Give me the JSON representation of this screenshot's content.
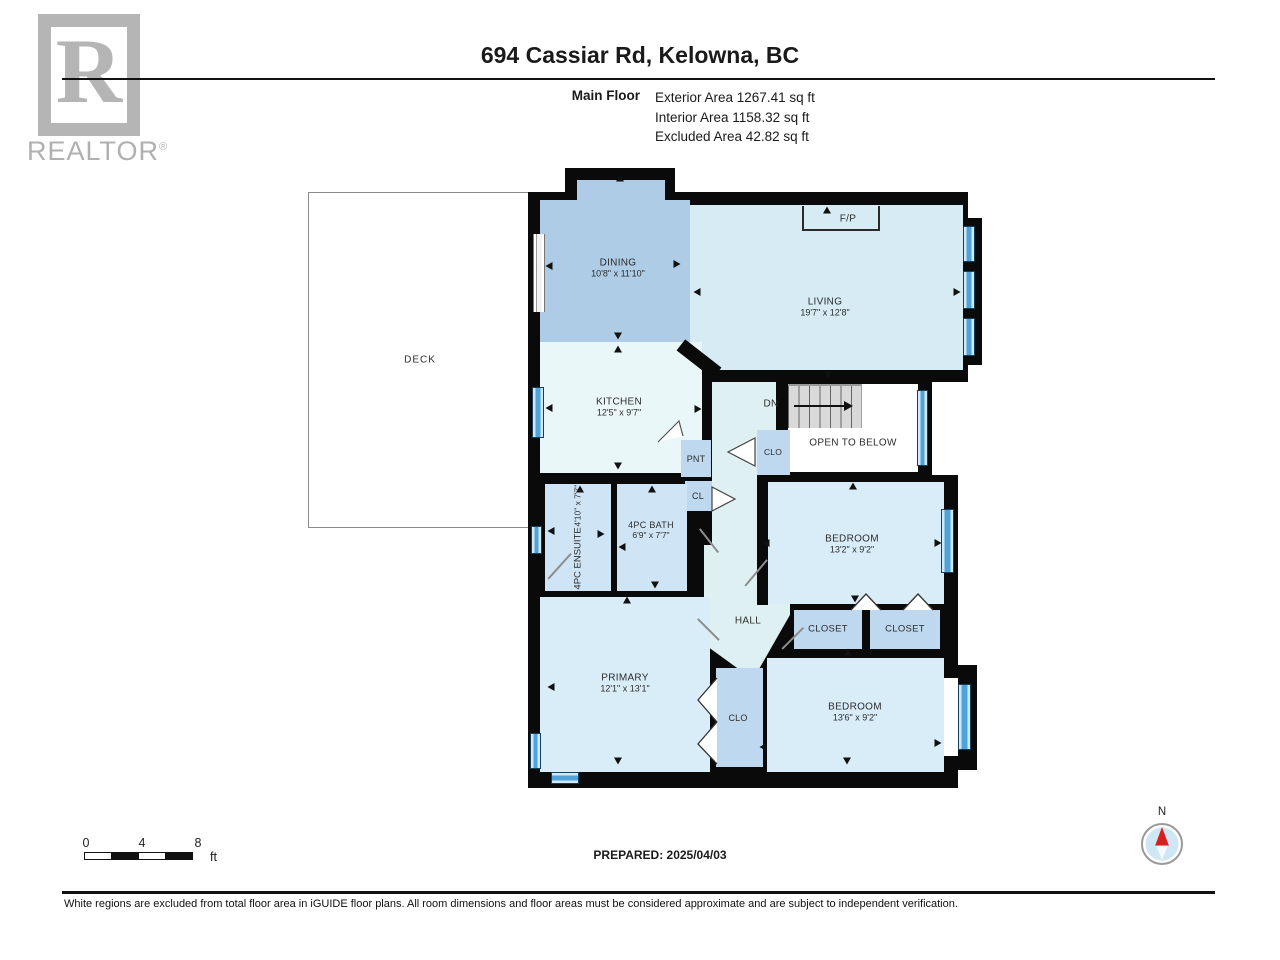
{
  "header": {
    "logo_word": "REALTOR",
    "logo_reg": "®",
    "logo_letter": "R",
    "title": "694 Cassiar Rd, Kelowna, BC",
    "floor_label": "Main Floor",
    "area_lines": {
      "exterior": "Exterior Area 1267.41 sq ft",
      "interior": "Interior Area 1158.32 sq ft",
      "excluded": "Excluded Area 42.82 sq ft"
    }
  },
  "rooms": {
    "deck": {
      "name": "DECK"
    },
    "dining": {
      "name": "DINING",
      "dims": "10'8\" x 11'10\""
    },
    "living": {
      "name": "LIVING",
      "dims": "19'7\" x 12'8\""
    },
    "kitchen": {
      "name": "KITCHEN",
      "dims": "12'5\" x 9'7\""
    },
    "fireplace": {
      "name": "F/P"
    },
    "stairs_down": {
      "name": "DN"
    },
    "open_below": {
      "name": "OPEN TO BELOW"
    },
    "clo_stairs": {
      "name": "CLO"
    },
    "pantry": {
      "name": "PNT"
    },
    "cl": {
      "name": "CL"
    },
    "ensuite": {
      "name": "4PC ENSUITE",
      "dims": "4'10\" x 7'7\""
    },
    "bath": {
      "name": "4PC BATH",
      "dims": "6'9\" x 7'7\""
    },
    "bedroom1": {
      "name": "BEDROOM",
      "dims": "13'2\" x 9'2\""
    },
    "hall": {
      "name": "HALL"
    },
    "closet1": {
      "name": "CLOSET"
    },
    "closet2": {
      "name": "CLOSET"
    },
    "primary": {
      "name": "PRIMARY",
      "dims": "12'1\" x 13'1\""
    },
    "clo_primary": {
      "name": "CLO"
    },
    "bedroom2": {
      "name": "BEDROOM",
      "dims": "13'6\" x 9'2\""
    }
  },
  "footer": {
    "scale": {
      "tick0": "0",
      "tick1": "4",
      "tick2": "8",
      "unit": "ft"
    },
    "prepared": "PREPARED: 2025/04/03",
    "compass_label": "N",
    "disclaimer": "White regions are excluded from total floor area in iGUIDE floor plans. All room dimensions and floor areas must be considered approximate and are subject to independent verification."
  },
  "colors": {
    "wall": "#0a0a0a",
    "dining": "#aecce6",
    "living": "#d6ebf4",
    "kitchen": "#eaf7f9",
    "bedroom": "#d9edf9",
    "bathroom": "#cfe5f6",
    "closet": "#bed8ef",
    "hall": "#dff0f2",
    "window": "#4fa3d8",
    "stairs": "#d9d9d9",
    "compass_north": "#d81f1f"
  }
}
